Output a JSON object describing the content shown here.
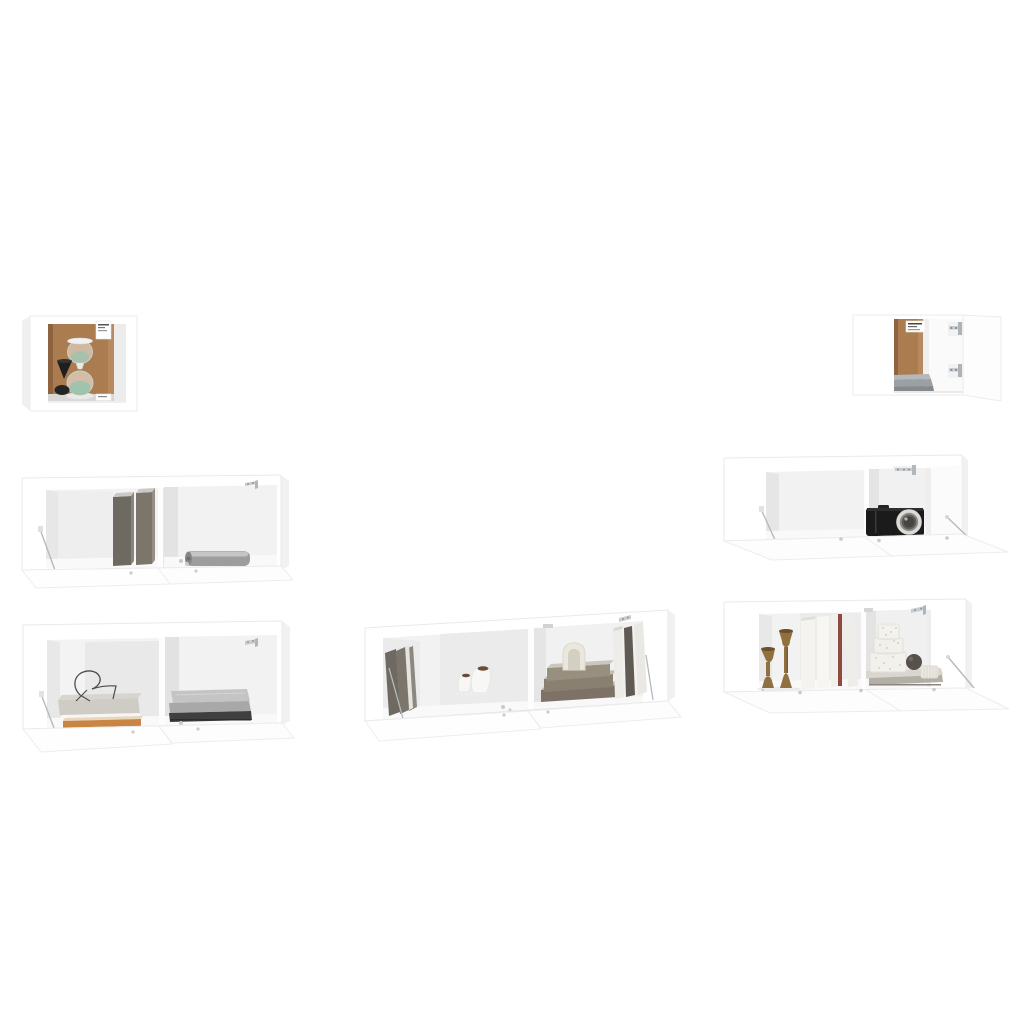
{
  "scene": {
    "description": "Product photo of a 7-piece white wall-mounted TV cabinet set with open compartments, drop-down doors and decorative styling items, on a plain white background",
    "background": "#ffffff"
  },
  "colors": {
    "background": "#ffffff",
    "frame_white": "#ffffff",
    "frame_stroke": "#eaeaea",
    "top_face": "#f8f8f8",
    "side_panel": "#f1f1f1",
    "door_white": "#fdfdfd",
    "interior_back": "#f2f2f2",
    "interior_wall": "#e7e7e7",
    "floor_strip": "#f9f9f9",
    "cork_back": "#ab7c50",
    "cork_dark": "#8e6440",
    "cork_light": "#b8895e",
    "sand_green": "#9fc3ad",
    "black_decor": "#1f1f1f",
    "glass_stroke": "#ccd2ce",
    "metal": "#b6babd",
    "metal_light": "#c9ccd0",
    "book_dark": "#6f6a61",
    "book_dark2": "#7b756b",
    "book_top": "#cbc9c4",
    "book_white": "#f4f3f0",
    "book_tan": "#c98543",
    "maroon_spine": "#8e4a3c",
    "gray_book1": "#b4b8ba",
    "gray_book2": "#9aa0a3",
    "gray_book3": "#848a8d",
    "roll_gray": "#9d9d9d",
    "blanket_light": "#c4c4c4",
    "blanket_mid": "#a8a8a8",
    "blanket_dark": "#3f3f3f",
    "wood_brown": "#91703f",
    "wood_dark": "#7a5c33",
    "camera_black": "#1b1b1b",
    "lens_silver": "#dcdad6",
    "lens_mid": "#8d8b86",
    "lens_dark": "#454440",
    "cream_arch": "#eae7dd",
    "taupe_spine": "#7d7265",
    "speckle": "#b9b5ad",
    "sphere_gray": "#56514b",
    "soil_brown": "#6a4c36",
    "wire_dark": "#4c4c4c",
    "stack_gray_book": "#cfccc6"
  },
  "units": [
    {
      "id": "small-cube-cabinet",
      "label": "Small square wall cabinet",
      "decor": [
        "hourglass with green sand",
        "black cone ornament",
        "product labels"
      ]
    },
    {
      "id": "small-wide-cabinet",
      "label": "Small wide wall cabinet with open door",
      "decor": [
        "stacked gray books",
        "wall-mount brackets",
        "product label"
      ]
    },
    {
      "id": "mid-left-unit",
      "label": "Hanging TV cabinet, two compartments, doors open",
      "decor": [
        "two standing dark books",
        "rolled gray blanket"
      ]
    },
    {
      "id": "mid-right-unit",
      "label": "Hanging TV cabinet, drop-down door open",
      "decor": [
        "black compact camera",
        "wall-mount bracket"
      ]
    },
    {
      "id": "bottom-left-unit",
      "label": "Hanging TV cabinet, two compartments, doors open",
      "decor": [
        "book stack with wire chair ornament",
        "three folded blankets"
      ]
    },
    {
      "id": "center-unit",
      "label": "Hanging TV cabinet, two compartments, doors open",
      "decor": [
        "leaning books",
        "two white vases with soil",
        "stacked books with cream arch ornament",
        "standing books"
      ]
    },
    {
      "id": "bottom-right-unit",
      "label": "Hanging TV cabinet, drop-down door open",
      "decor": [
        "two turned-wood candle holders",
        "standing books with maroon spine",
        "tiered speckled vase",
        "dark sphere ornament",
        "ribbed box"
      ]
    }
  ]
}
